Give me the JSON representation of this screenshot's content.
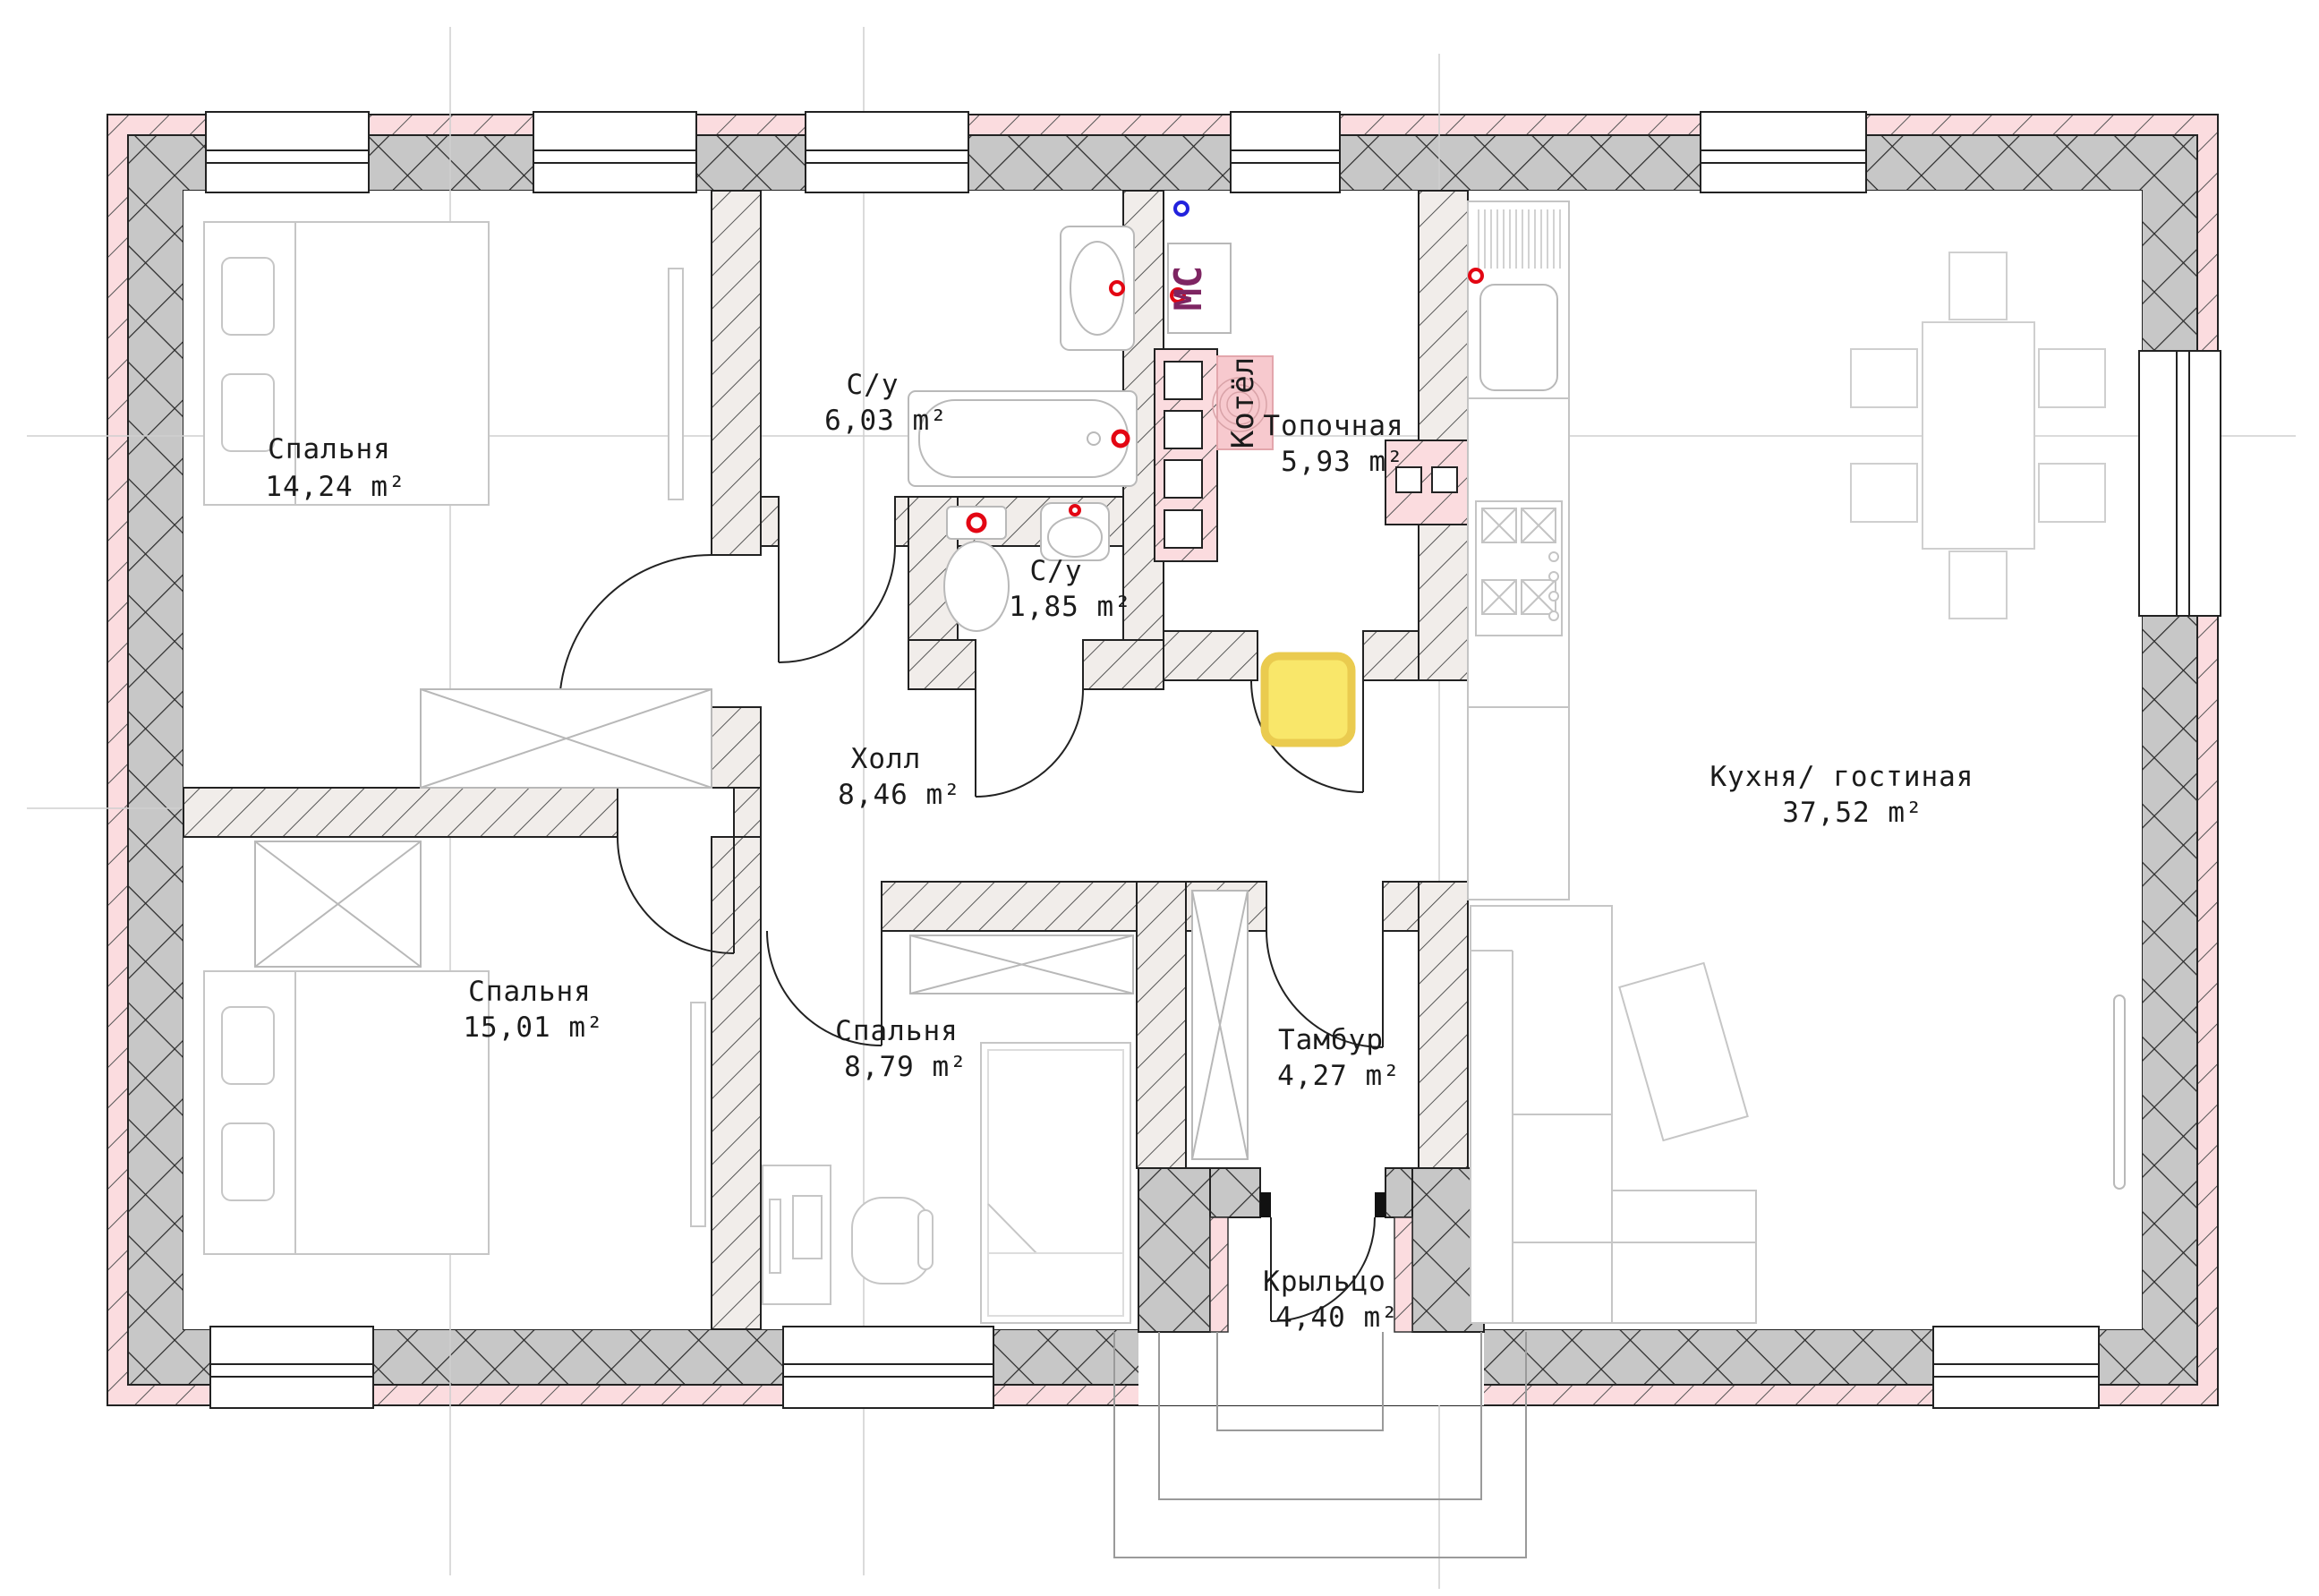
{
  "plan": {
    "type": "floor-plan-first-floor",
    "language": "ru",
    "rooms": [
      {
        "name": "Спальня",
        "area": "14,24 m²"
      },
      {
        "name": "С/у",
        "area": "6,03 m²"
      },
      {
        "name": "Топочная",
        "area": "5,93 m²"
      },
      {
        "name": "С/у",
        "area": "1,85 m²"
      },
      {
        "name": "Холл",
        "area": "8,46 m²"
      },
      {
        "name": "Кухня/ гостиная",
        "area": "37,52 m²"
      },
      {
        "name": "Спальня",
        "area": "15,01 m²"
      },
      {
        "name": "Спальня",
        "area": "8,79 m²"
      },
      {
        "name": "Тамбур",
        "area": "4,27 m²"
      },
      {
        "name": "Крыльцо",
        "area": "4,40 m²"
      }
    ],
    "equipment": {
      "boiler": "Котёл",
      "washing_machine": "МС"
    },
    "colors": {
      "insulation_pink": "#FBDCDF",
      "masonry_gray": "#C7C7C7",
      "interior_wall": "#F1EDEA",
      "highlight_yellow": "#F9E76A",
      "water_point_red": "#E30613",
      "power_point_blue": "#2222DD",
      "washing_machine_label": "#7E2562"
    }
  }
}
